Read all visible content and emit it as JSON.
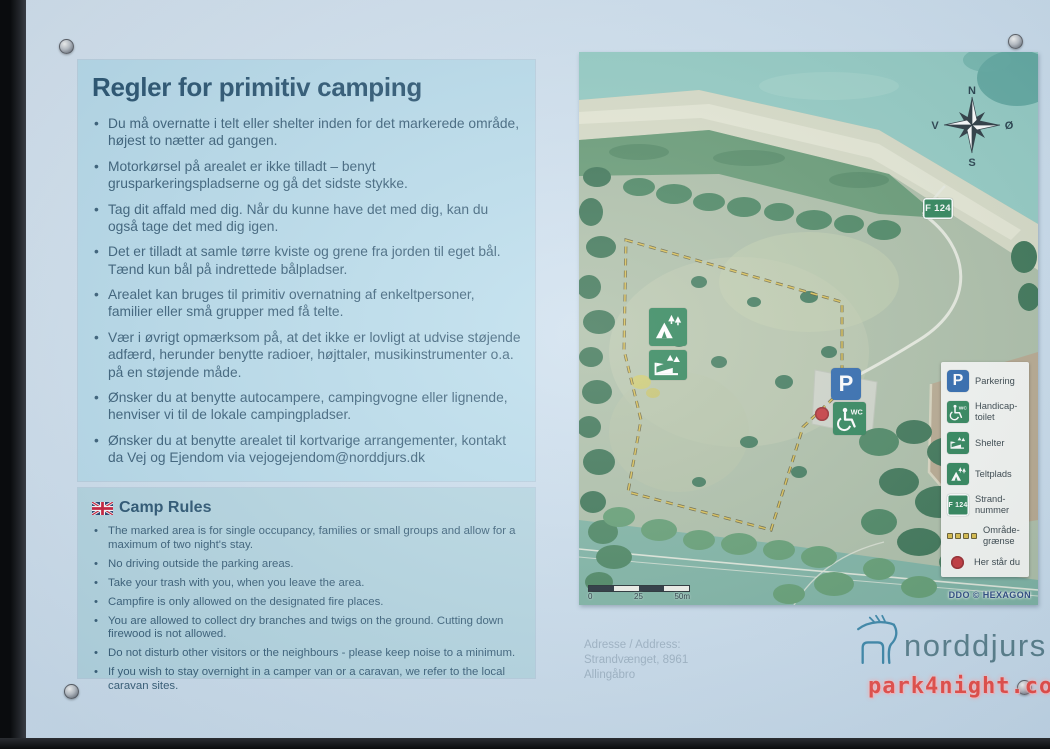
{
  "sign": {
    "danish": {
      "title": "Regler for primitiv camping",
      "bullets": [
        "Du må overnatte i telt eller shelter inden for det markerede område, højest to nætter ad gangen.",
        "Motorkørsel på arealet er ikke tilladt – benyt grusparkeringspladserne og gå det sidste stykke.",
        "Tag dit affald med dig. Når du kunne have det med dig, kan du også tage det med dig igen.",
        "Det er tilladt at samle tørre kviste og grene fra jorden til eget bål. Tænd kun bål på indrettede bålpladser.",
        "Arealet kan bruges til primitiv overnatning af enkeltpersoner, familier eller små grupper med få telte.",
        "Vær i øvrigt opmærksom på, at det ikke er lovligt at udvise støjende adfærd, herunder benytte radioer, højttaler, musikinstrumenter o.a. på en støjende måde.",
        "Ønsker du at benytte autocampere, campingvogne eller lignende, henviser vi til de lokale campingpladser.",
        "Ønsker du at benytte arealet til kortvarige arrangementer, kontakt da Vej og Ejendom via vejogejendom@norddjurs.dk"
      ]
    },
    "english": {
      "title": "Camp Rules",
      "bullets": [
        "The marked area is for single occupancy, families or small groups and allow for a maximum of two night's stay.",
        "No driving outside the parking areas.",
        "Take your trash with you, when you leave the area.",
        "Campfire is only allowed on the designated fire places.",
        "You are allowed to collect dry branches and twigs on the ground. Cutting down firewood is not allowed.",
        "Do not disturb other visitors or the neighbours - please keep noise to a minimum.",
        "If you wish to stay overnight in a camper van or a caravan, we refer to the local caravan sites."
      ]
    },
    "address": {
      "label": "Adresse / Address:",
      "street": "Strandvænget, 8961",
      "city": "Allingåbro"
    },
    "logo_text": "norddjurs",
    "watermark": "park4night.com"
  },
  "map": {
    "compass": {
      "north": "N",
      "east": "Ø",
      "south": "S",
      "west": "V"
    },
    "signs": {
      "parking_glyph": "P",
      "wc_glyph": "WC",
      "beach_sign": "F 124"
    },
    "scale": {
      "zero": "0",
      "mid": "25",
      "end": "50m"
    },
    "credit": "DDO © HEXAGON",
    "legend": [
      {
        "name": "parking",
        "label": "Parkering"
      },
      {
        "name": "handicap-toilet",
        "label": "Handicap-\ntoilet"
      },
      {
        "name": "shelter",
        "label": "Shelter"
      },
      {
        "name": "tent",
        "label": "Teltplads"
      },
      {
        "name": "beach-number",
        "label": "Strand-\nnummer"
      },
      {
        "name": "area-boundary",
        "label": "Område-\ngrænse"
      },
      {
        "name": "you-are-here",
        "label": "Her står du"
      }
    ]
  },
  "colors": {
    "panel_blue": "#b6dbeb",
    "title_navy": "#1d4a68",
    "sign_green": "#1d7a4b",
    "sign_blue": "#1c5ba6",
    "dot_red": "#c1272d",
    "boundary_yellow": "#a08c2e",
    "logo_teal": "#2e7fa3",
    "watermark_red": "#e8433d"
  }
}
